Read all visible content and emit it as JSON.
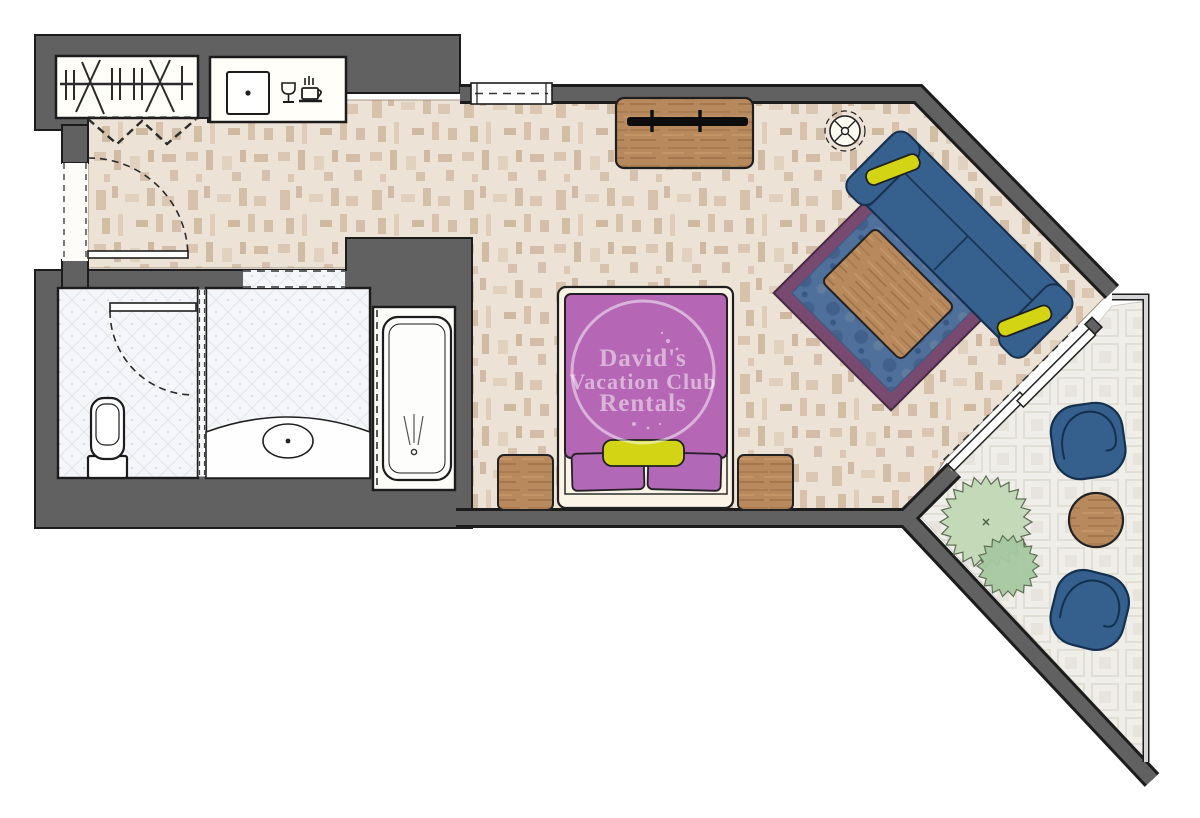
{
  "watermark": {
    "line1": "David's",
    "line2": "Vacation Club",
    "line3": "Rentals"
  },
  "palette": {
    "wall": "#616161",
    "wall_outline": "#1c1c1c",
    "carpet": "#ece2d6",
    "carpet_mottle": "#cfb89f",
    "tile_base": "#f5f6fa",
    "tile_line": "#e0e4ee",
    "balcony_base": "#f0eee9",
    "balcony_square": "#e1ded6",
    "wood": "#b9895e",
    "wood_grain": "#a6784d",
    "sofa_blue": "#36618f",
    "sofa_outline": "#17304d",
    "chair_blue": "#35608d",
    "rug_blue": "#50709c",
    "rug_border": "#784a70",
    "bed_purple": "#b566b4",
    "pillow_purple": "#b168b6",
    "accent_yellow": "#d3d414",
    "plant_green": "#c3d9b7",
    "plant_green_dark": "#a6c9a0",
    "fixture_white": "#ffffff",
    "bed_linen": "#f9f4e6",
    "railing_gray": "#d6d6d6"
  },
  "icons": {
    "hangers": "closet-hangers-icon",
    "wine_glass": "wine-glass-icon",
    "coffee_cup": "coffee-cup-icon",
    "tv": "tv-icon",
    "floor_lamp": "floor-lamp-icon",
    "sink": "sink-icon",
    "toilet": "toilet-icon",
    "bathtub": "bathtub-icon",
    "plant": "plant-icon"
  }
}
